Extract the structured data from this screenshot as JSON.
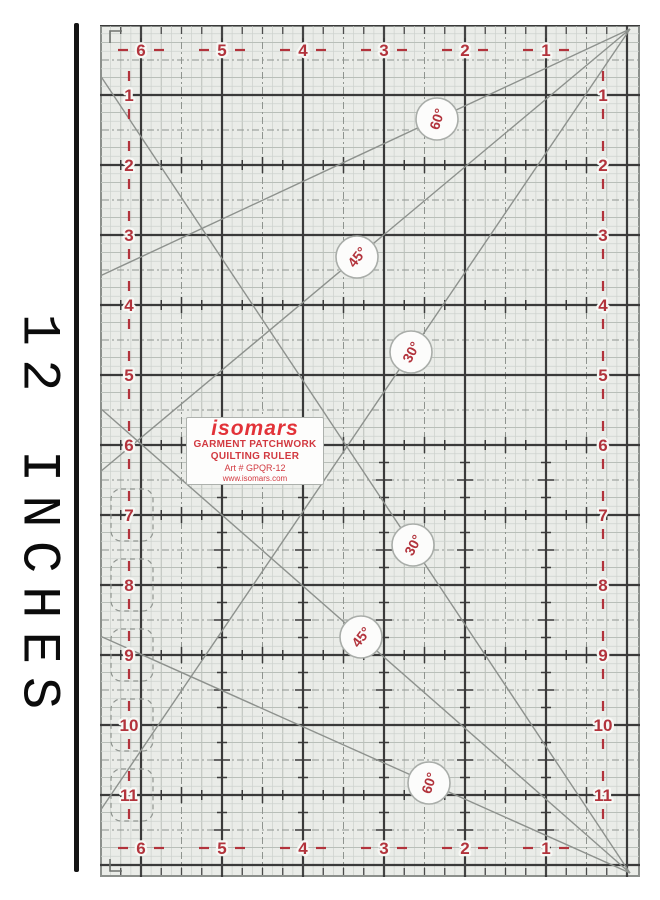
{
  "side": {
    "length_label": "12 INCHES"
  },
  "brand": {
    "logo": "isomars",
    "tagline1": "GARMENT PATCHWORK",
    "tagline2": "QUILTING RULER",
    "art_number": "Art # GPQR-12",
    "website": "www.isomars.com"
  },
  "colors": {
    "red": "#b2333c",
    "brand_red": "#d23940",
    "ruler_bg": "#eaece8",
    "major": "#3a3a3a",
    "fine": "#cdd1cd",
    "quarter": "#b9bfb9",
    "half": "#8f948f",
    "diagonal": "#8d918d",
    "circle_ring": "#a9ada9",
    "circle_fill": "#fcfcfb",
    "edge": "#8c908c",
    "halo": "#f7f8f5",
    "edge_tick": "#4a4a4a",
    "bracket": "#8f948f"
  },
  "ruler": {
    "top_numbers": [
      "6",
      "5",
      "4",
      "3",
      "2",
      "1"
    ],
    "bottom_numbers": [
      "6",
      "5",
      "4",
      "3",
      "2",
      "1"
    ],
    "left_numbers": [
      "1",
      "2",
      "3",
      "4",
      "5",
      "6",
      "7",
      "8",
      "9",
      "10",
      "11"
    ],
    "right_numbers": [
      "1",
      "2",
      "3",
      "4",
      "5",
      "6",
      "7",
      "8",
      "9",
      "10",
      "11"
    ],
    "angle_badges": [
      {
        "label": "60°",
        "cx": 337,
        "cy": 94,
        "rot": -72
      },
      {
        "label": "45°",
        "cx": 257,
        "cy": 232,
        "rot": -52
      },
      {
        "label": "30°",
        "cx": 311,
        "cy": 327,
        "rot": -62
      },
      {
        "label": "30°",
        "cx": 313,
        "cy": 520,
        "rot": -62
      },
      {
        "label": "45°",
        "cx": 261,
        "cy": 612,
        "rot": -52
      },
      {
        "label": "60°",
        "cx": 329,
        "cy": 758,
        "rot": -72
      }
    ],
    "diagonals": [
      {
        "name": "line-60-from-top",
        "x1": 530,
        "y1": 4,
        "x2": 0,
        "y2": 251
      },
      {
        "name": "line-45-from-top",
        "x1": 530,
        "y1": 4,
        "x2": 0,
        "y2": 447
      },
      {
        "name": "line-30-from-top",
        "x1": 530,
        "y1": 4,
        "x2": 0,
        "y2": 786
      },
      {
        "name": "line-60-from-bottom",
        "x1": 530,
        "y1": 848,
        "x2": 0,
        "y2": 611
      },
      {
        "name": "line-45-from-bottom",
        "x1": 530,
        "y1": 848,
        "x2": 0,
        "y2": 383
      },
      {
        "name": "line-30-from-bottom",
        "x1": 530,
        "y1": 848,
        "x2": 0,
        "y2": 50
      }
    ],
    "ticked_rows": [
      2,
      4,
      6,
      7,
      9,
      11
    ],
    "ticked_cols": [
      1,
      2,
      3,
      4,
      5
    ],
    "bracket_rows": [
      7,
      8,
      9,
      10,
      11
    ]
  },
  "geometry": {
    "px_per_inch_x": 81,
    "px_per_inch_y": 70,
    "x_zero": 527,
    "rows": 12,
    "cols": 6,
    "width": 540,
    "height": 852
  }
}
